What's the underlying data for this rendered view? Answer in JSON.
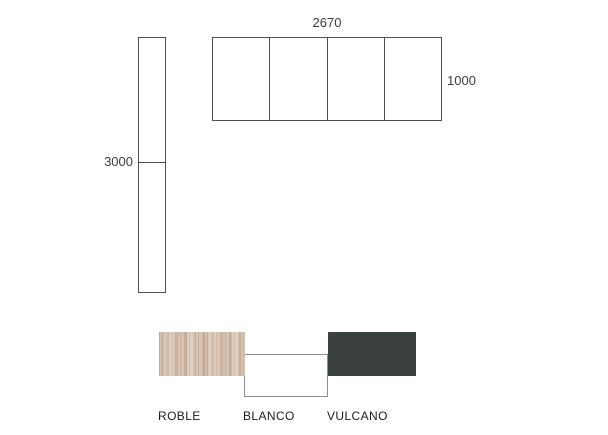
{
  "diagram": {
    "units": {
      "top": {
        "width_label": "2670",
        "height_label": "1000",
        "door_count": 4
      },
      "side": {
        "height_label": "3000",
        "section_count": 2
      }
    },
    "outline_color": "#4f4f4f",
    "finishes": [
      {
        "name": "ROBLE",
        "type": "wood-texture",
        "color": "#d5c1b0"
      },
      {
        "name": "BLANCO",
        "type": "solid",
        "color": "#ffffff",
        "border_color": "#8f8f8f"
      },
      {
        "name": "VULCANO",
        "type": "solid",
        "color": "#3b423e"
      }
    ]
  }
}
